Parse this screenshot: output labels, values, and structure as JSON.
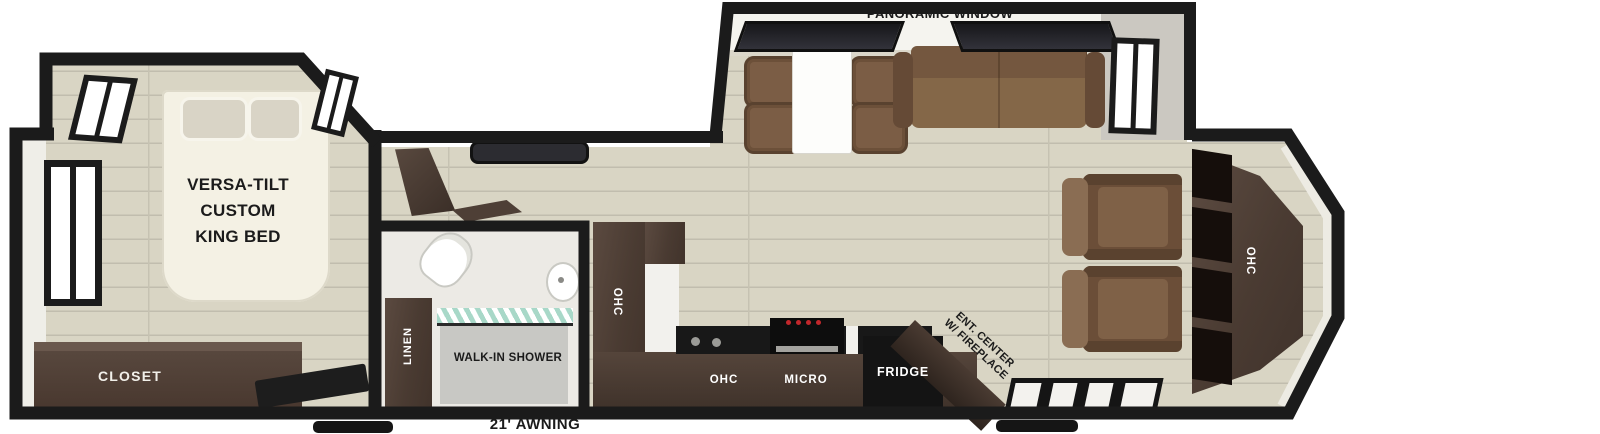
{
  "meta": {
    "title": "Travel trailer floor plan",
    "width": 1600,
    "height": 434
  },
  "labels": {
    "panoramic_window": "PANORAMIC WINDOW",
    "king_bed": "VERSA-TILT\nCUSTOM\nKING BED",
    "closet": "CLOSET",
    "linen": "LINEN",
    "walk_in_shower": "WALK-IN SHOWER",
    "ohc_pantry": "OHC",
    "ohc_kitchen": "OHC",
    "micro": "MICRO",
    "fridge": "FRIDGE",
    "ent_center": "ENT. CENTER\nW/ FIREPLACE",
    "ohc_rear": "OHC",
    "awning": "21' AWNING"
  },
  "colors": {
    "wall": "#1b1b1b",
    "floor": "#d9d5c4",
    "floor_line": "#c1bdae",
    "cabinet_dark": "#4e3e35",
    "sofa_brown": "#795c43",
    "chair_brown": "#6b4e38",
    "bed_cream": "#f4f1e4",
    "pillow": "#d9d4c6",
    "appliance_black": "#141414",
    "stove_knob_red": "#c2272b",
    "shower_glass_teal": "#a8d8c8",
    "label_dark": "#1b1b1b",
    "label_light": "#ffffff"
  }
}
